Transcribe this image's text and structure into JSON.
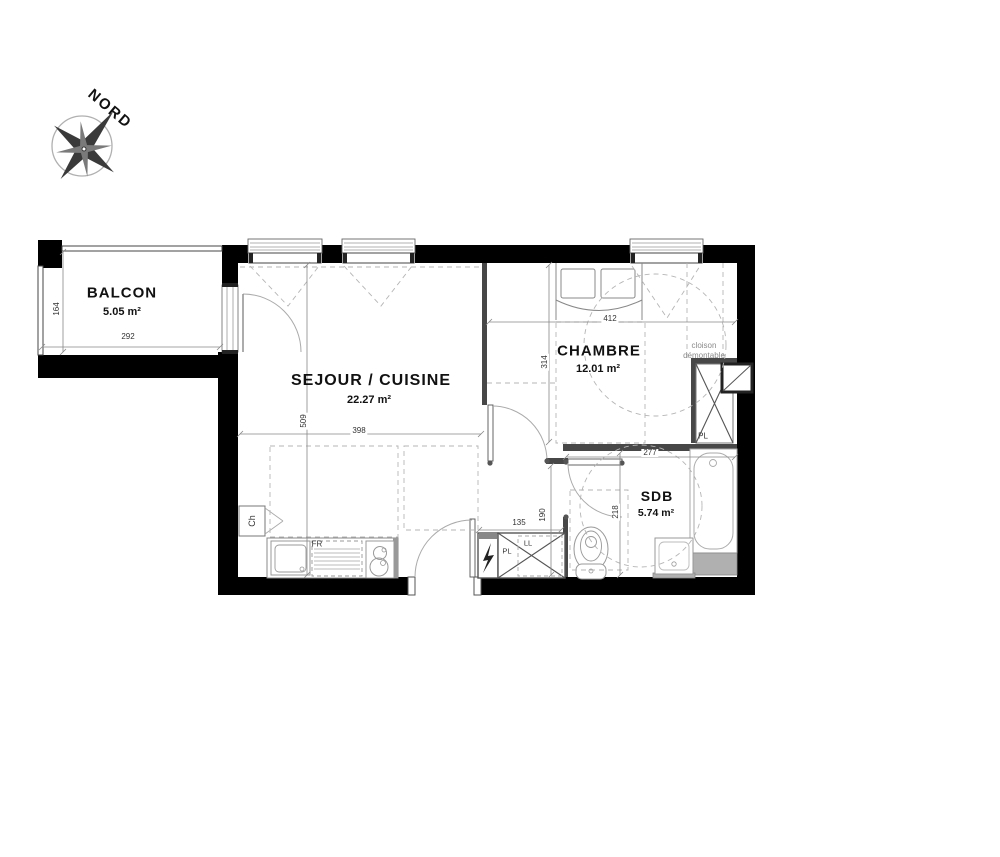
{
  "compass": {
    "label": "NORD"
  },
  "rooms": {
    "balcon": {
      "name": "BALCON",
      "area": "5.05 m²"
    },
    "sejour": {
      "name": "SEJOUR / CUISINE",
      "area": "22.27 m²"
    },
    "chambre": {
      "name": "CHAMBRE",
      "area": "12.01 m²"
    },
    "sdb": {
      "name": "SDB",
      "area": "5.74 m²"
    }
  },
  "dimensions": {
    "balcon_height": "164",
    "balcon_width": "292",
    "sejour_height": "509",
    "sejour_width": "398",
    "chambre_height": "314",
    "chambre_width": "412",
    "sdb_width": "277",
    "sdb_height": "218",
    "hall_height": "190",
    "hall_width": "135"
  },
  "annotations": {
    "cloison_line1": "cloison",
    "cloison_line2": "démontable",
    "water_heater": "Ch",
    "fridge": "FR",
    "closet_hall": "PL",
    "washer": "LL",
    "closet_chambre": "PL"
  },
  "colors": {
    "exterior_wall": "#000000",
    "partition_wall": "#474747",
    "fixture_stroke": "#999999",
    "dashed_line": "#b5b5b5",
    "dimension_text": "#333333"
  }
}
